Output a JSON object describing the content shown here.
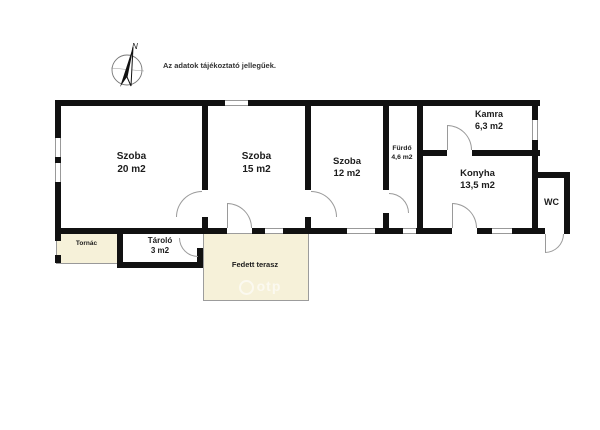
{
  "disclaimer": "Az adatok tájékoztató jellegűek.",
  "compass": {
    "north_label": "N"
  },
  "watermark": "otp",
  "colors": {
    "wall": "#111111",
    "porch_fill": "#f6f1d9",
    "door_arc": "#9a9a9a",
    "label_text": "#1c1c1c",
    "background": "#ffffff"
  },
  "rooms": {
    "szoba20": {
      "name": "Szoba",
      "area": "20 m2"
    },
    "szoba15": {
      "name": "Szoba",
      "area": "15 m2"
    },
    "szoba12": {
      "name": "Szoba",
      "area": "12 m2"
    },
    "furdo": {
      "name": "Fürdő",
      "area": "4,6 m2"
    },
    "kamra": {
      "name": "Kamra",
      "area": "6,3 m2"
    },
    "konyha": {
      "name": "Konyha",
      "area": "13,5 m2"
    },
    "wc": {
      "name": "WC"
    },
    "tornac": {
      "name": "Tornác"
    },
    "tarolo": {
      "name": "Tároló",
      "area": "3 m2"
    },
    "terasz": {
      "name": "Fedett terasz"
    }
  }
}
